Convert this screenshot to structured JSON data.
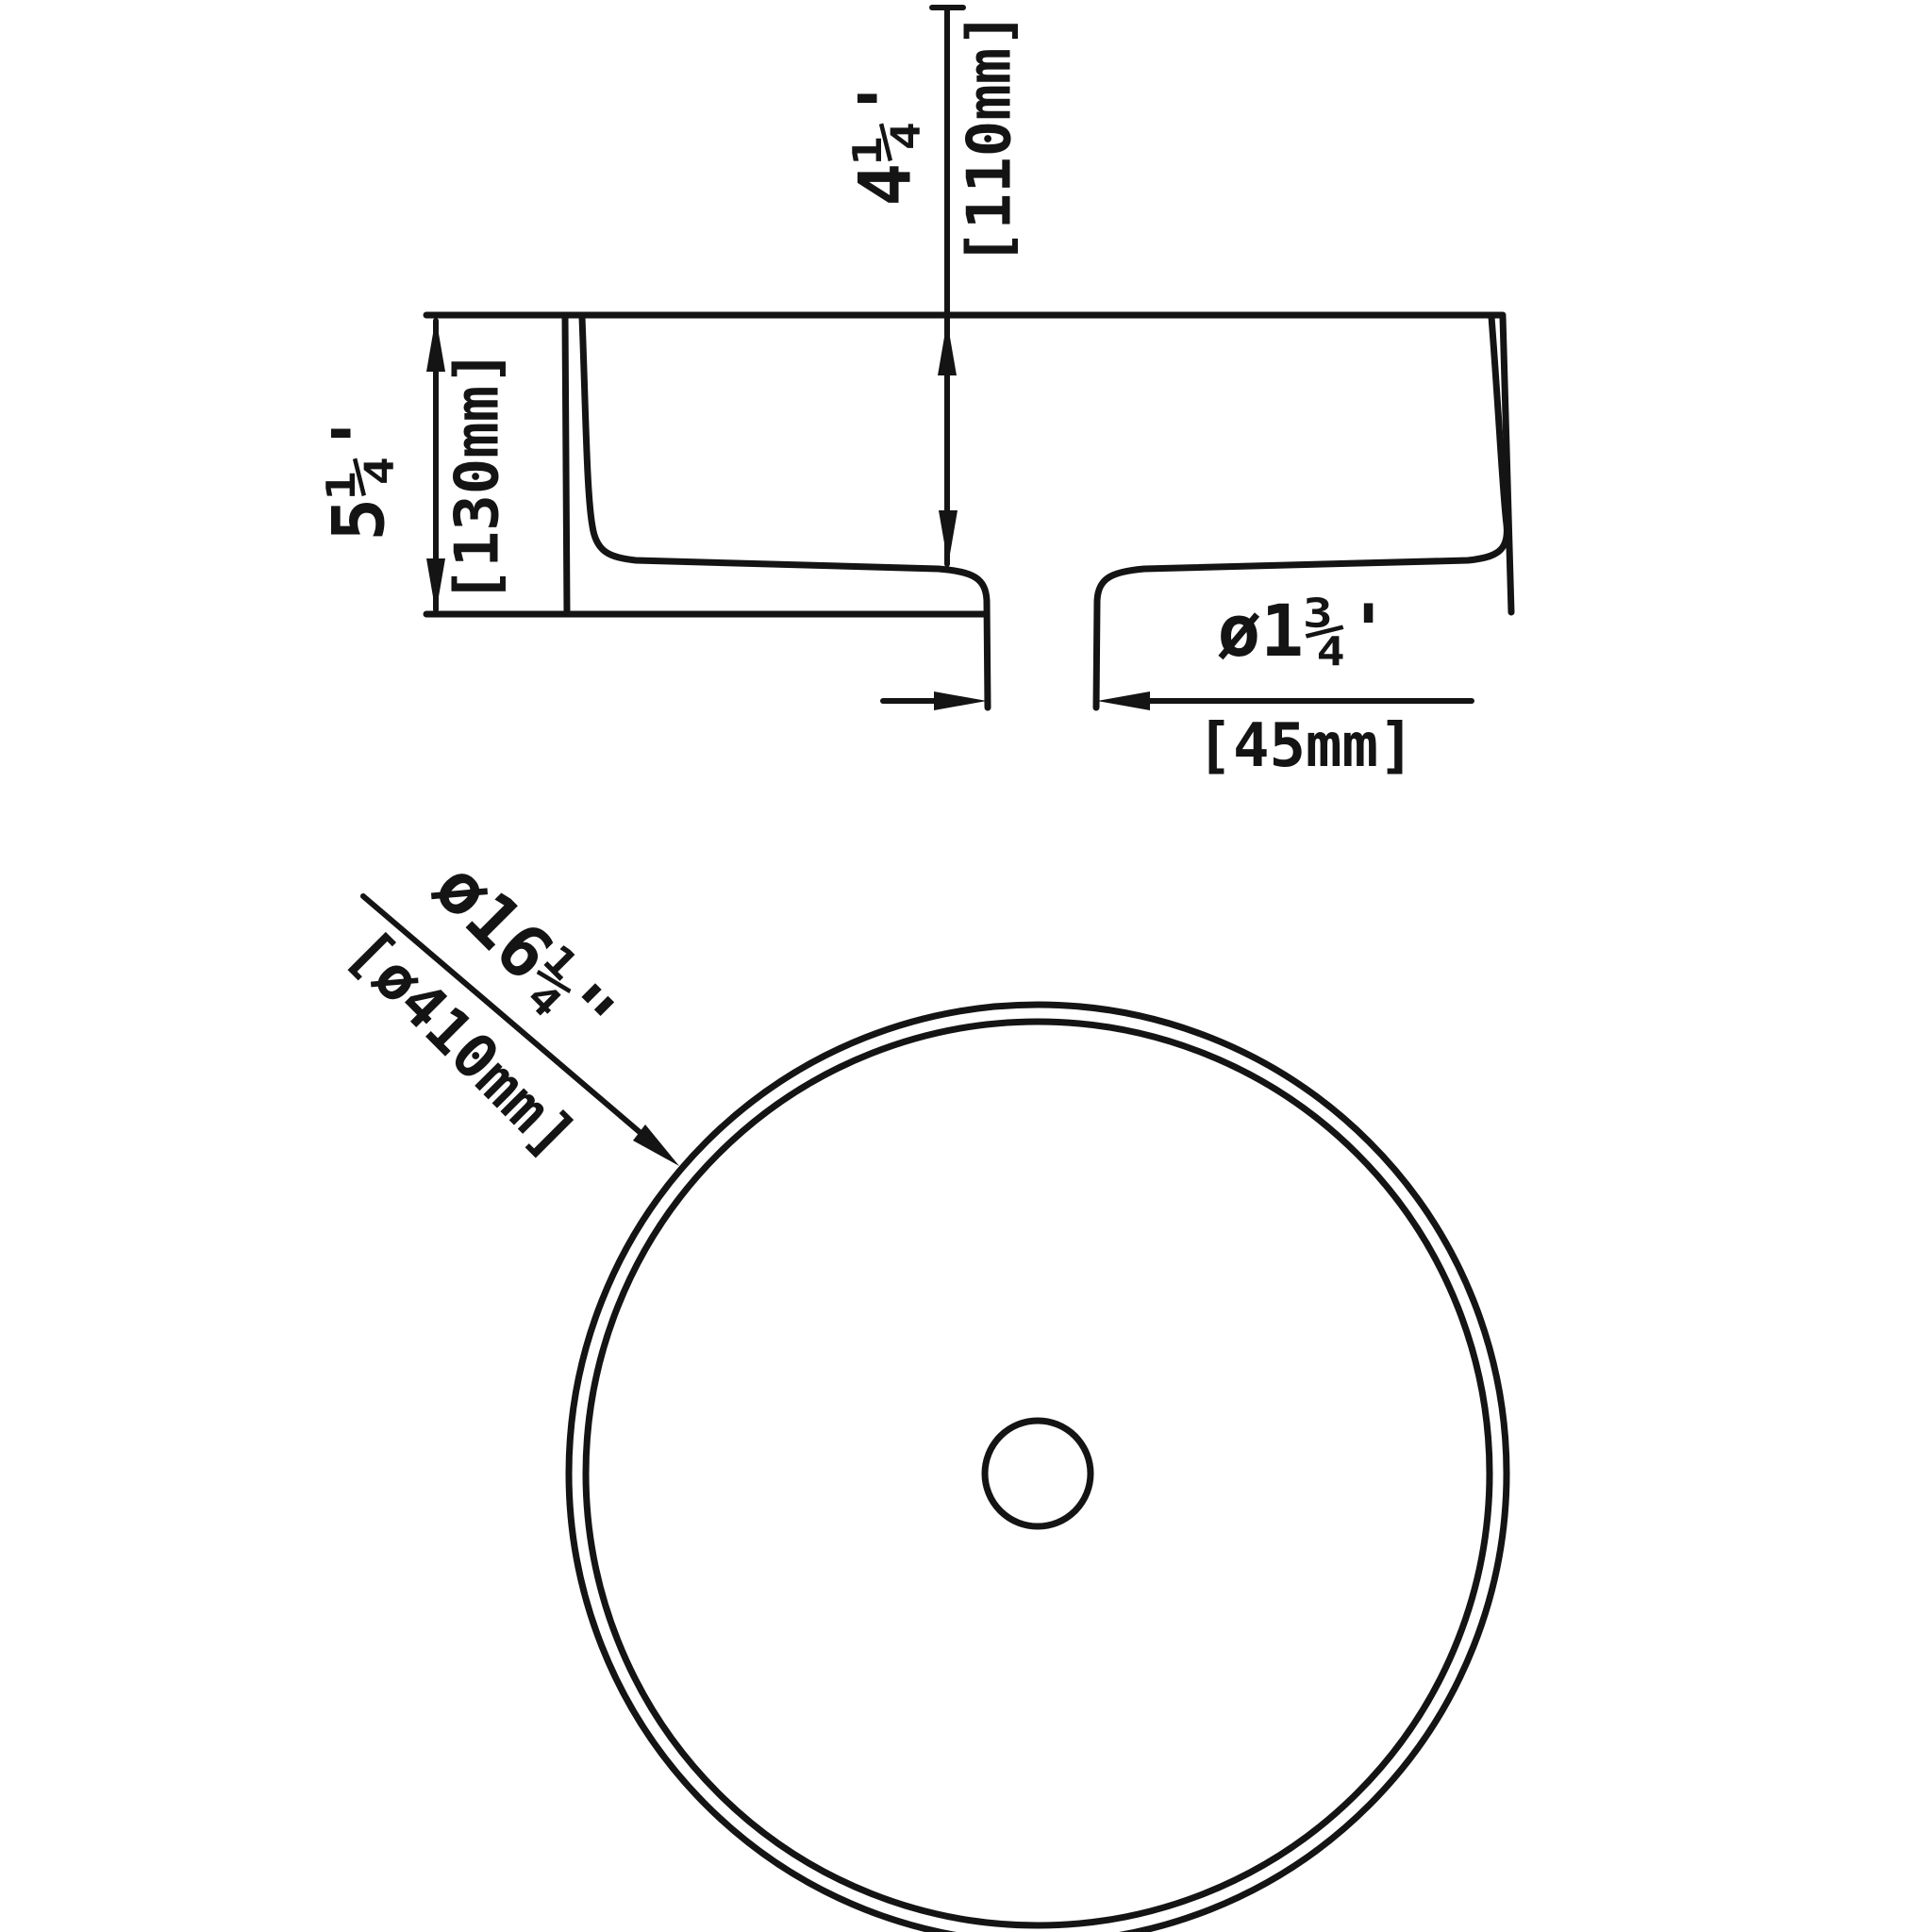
{
  "colors": {
    "background": "#ffffff",
    "ink": "#141414"
  },
  "dimensions": {
    "overall_height": {
      "inches": "5¼'",
      "mm": "[130mm]"
    },
    "basin_depth": {
      "inches": "4¼'",
      "mm": "[110mm]"
    },
    "drain_diameter": {
      "inches": "ø1¾'",
      "mm": "[45mm]"
    },
    "overall_diameter": {
      "inches": "ø16¼\"",
      "mm": "[ø410mm]"
    }
  }
}
